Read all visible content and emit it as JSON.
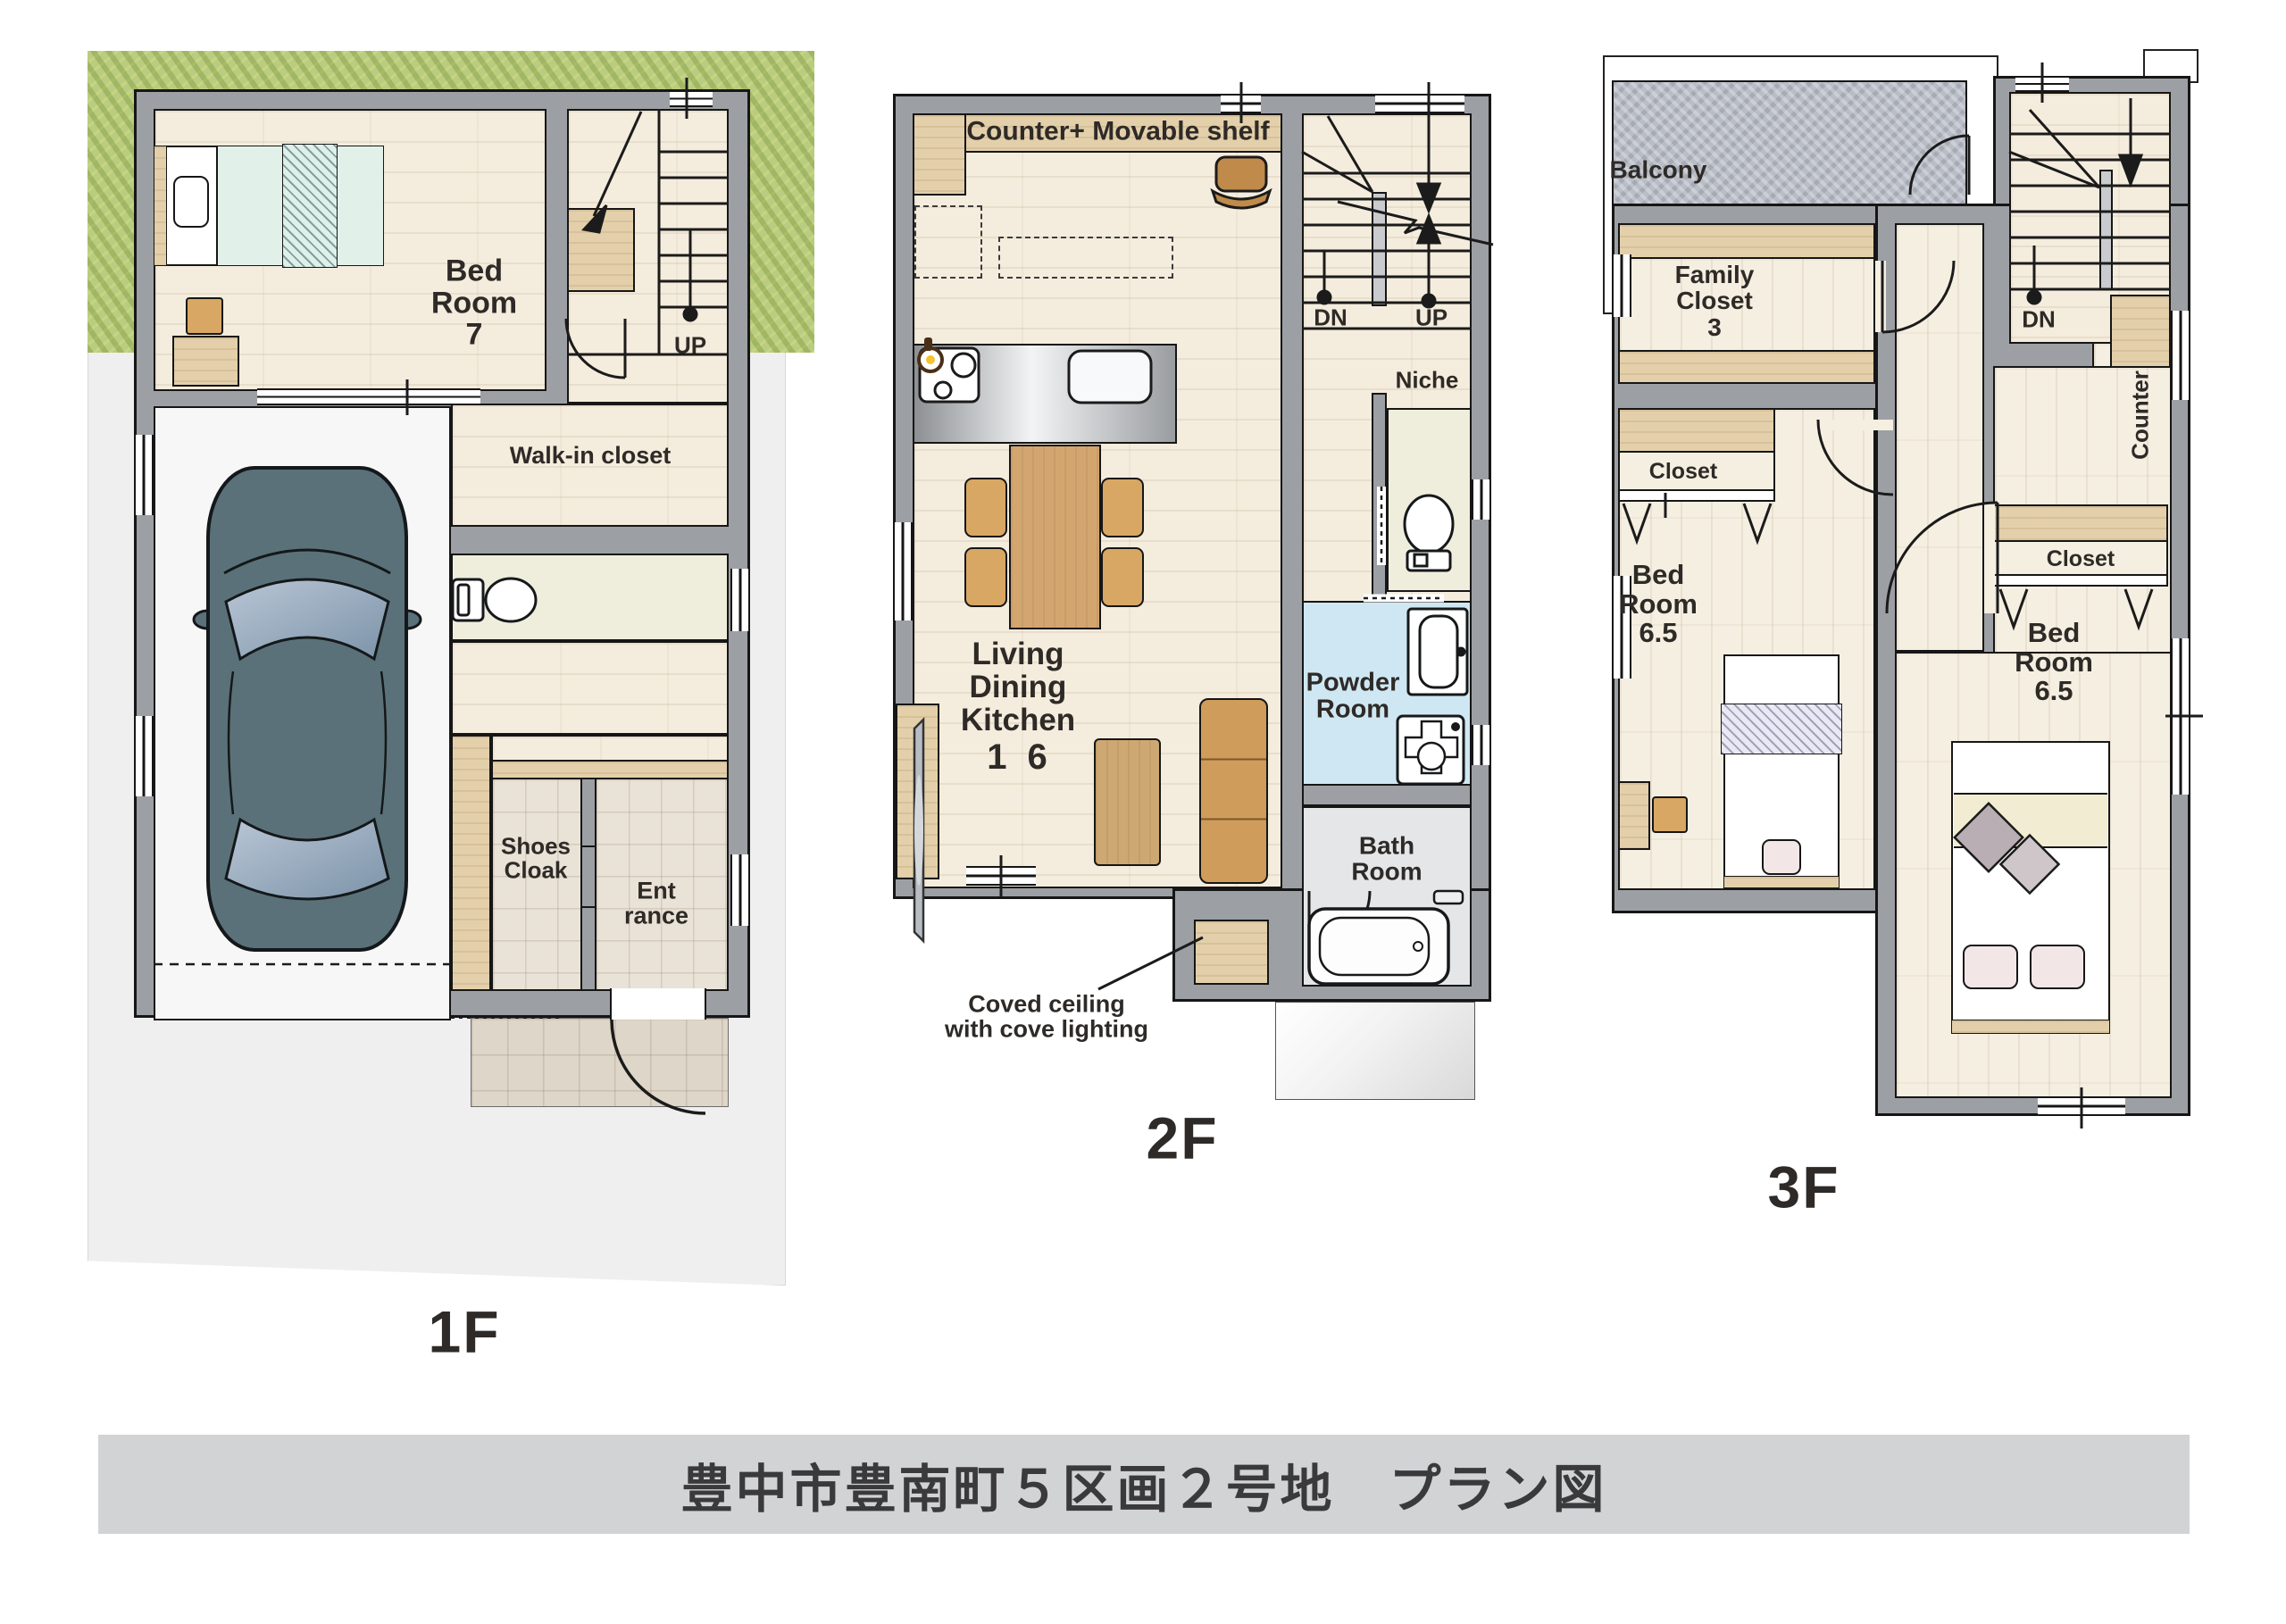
{
  "title": "豊中市豊南町５区画２号地　プラン図",
  "floors": {
    "f1": {
      "label": "1F",
      "bedroom": "Bed\nRoom\n7",
      "up": "UP",
      "walk_in": "Walk-in closet",
      "shoes": "Shoes\nCloak",
      "entrance": "Ent\nrance"
    },
    "f2": {
      "label": "2F",
      "counter_shelf": "Counter+ Movable shelf",
      "dn": "DN",
      "up": "UP",
      "niche": "Niche",
      "ldk": "Living\nDining\nKitchen",
      "ldk_size": "1 6",
      "powder": "Powder\nRoom",
      "bath": "Bath\nRoom",
      "note": "Coved ceiling\nwith cove lighting"
    },
    "f3": {
      "label": "3F",
      "balcony": "Balcony",
      "family_closet": "Family\nCloset\n3",
      "closet_left": "Closet",
      "bedroom_left": "Bed\nRoom\n6.5",
      "counter": "Counter",
      "dn": "DN",
      "closet_right": "Closet",
      "bedroom_right": "Bed\nRoom\n6.5"
    }
  },
  "colors": {
    "wall": "#9c9fa3",
    "wood_floor": "#f4ecdd",
    "wood_band": "#e3d0ab",
    "tile": "#e9e2d6",
    "grass": "#b9cc80",
    "lot": "#efeff0",
    "balcony": "#b9bdc6",
    "powder_room": "#cfe7f2",
    "bath_room": "#e4e6e8",
    "toilet_room": "#efeedd",
    "furniture_tan": "#d8a763",
    "car": "#5b7179",
    "title_bar": "#d2d3d5"
  }
}
